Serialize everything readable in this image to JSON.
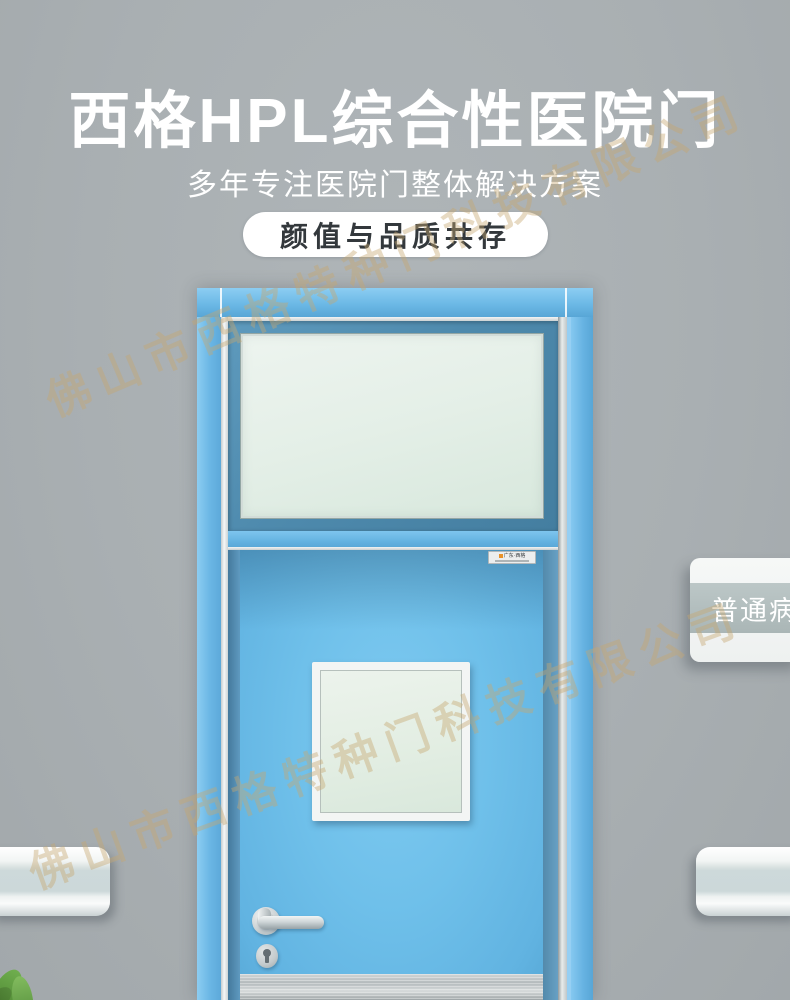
{
  "page": {
    "background_color": "#a9afb2",
    "door_blue": "#6fc0ea",
    "transom_frame_color": "#4e8aad",
    "glass_color": "#e6f0e8",
    "watermark_color": "#c8a870"
  },
  "header": {
    "title": "西格HPL综合性医院门",
    "subtitle": "多年专注医院门整体解决方案",
    "badge_label": "颜值与品质共存"
  },
  "watermark": {
    "text": "佛山市西格特种门科技有限公司"
  },
  "door": {
    "brand_plate": {
      "brand_text": "广东·西格"
    }
  },
  "room_sign": {
    "label": "普通病房"
  }
}
